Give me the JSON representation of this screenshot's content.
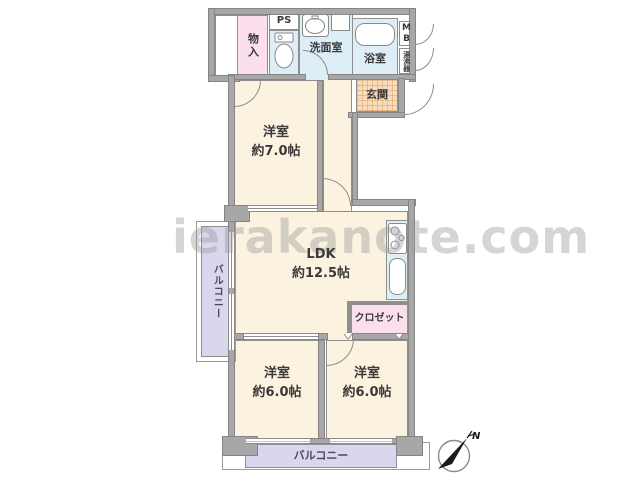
{
  "title": "apartment-floor-plan",
  "watermark": "ierakanote.com",
  "compass": {
    "north_label": "N"
  },
  "colors": {
    "wall_gray": "#a7a7a7",
    "room_cream": "#fcf2e0",
    "wet_blue": "#ddeef7",
    "pink": "#fbdfec",
    "entrance_tan": "#f8dcc0",
    "balcony_purple": "#d9d6ee"
  },
  "rooms": {
    "storage": {
      "label": "物入"
    },
    "pipe_space": {
      "label": "PS"
    },
    "washroom": {
      "label": "洗面室"
    },
    "bathroom": {
      "label": "浴室"
    },
    "meter_box": {
      "label": "MB"
    },
    "water_heater": {
      "label": "湯沸器"
    },
    "entrance": {
      "label": "玄関"
    },
    "western_room_7": {
      "label": "洋室",
      "size": "約7.0帖"
    },
    "ldk": {
      "label": "LDK",
      "size": "約12.5帖"
    },
    "closet": {
      "label": "クロゼット"
    },
    "western_room_6_left": {
      "label": "洋室",
      "size": "約6.0帖"
    },
    "western_room_6_right": {
      "label": "洋室",
      "size": "約6.0帖"
    },
    "balcony_left": {
      "label": "バルコニー"
    },
    "balcony_bottom": {
      "label": "バルコニー"
    }
  }
}
